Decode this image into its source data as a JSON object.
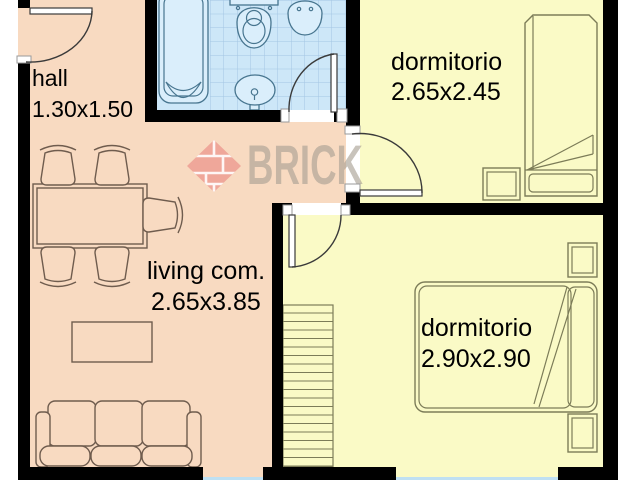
{
  "watermark": {
    "brand": "BRICK"
  },
  "rooms": {
    "hall": {
      "label": "hall",
      "dimensions": "1.30x1.50"
    },
    "bedroom_top": {
      "label": "dormitorio",
      "dimensions": "2.65x2.45"
    },
    "living": {
      "label": "living com.",
      "dimensions": "2.65x3.85"
    },
    "bedroom_bottom": {
      "label": "dormitorio",
      "dimensions": "2.90x2.90"
    }
  },
  "colors": {
    "wall": "#000000",
    "floor_warm": "#f8dac1",
    "floor_bedroom": "#fafac6",
    "floor_bath": "#cde7f8",
    "tile_line": "#a3c6e3",
    "fixture_fill": "#daeefb",
    "fixture_stroke": "#47758f",
    "furniture_warm": "#6f5c4e",
    "furniture_cool": "#7c7c58",
    "door_stroke": "#3a3a3a",
    "glass": "#bfe0f2",
    "jamb_stroke": "#9a9a9a",
    "label": "#000000",
    "watermark_text": "#a89f93",
    "logo_red": "#ec9a90"
  }
}
